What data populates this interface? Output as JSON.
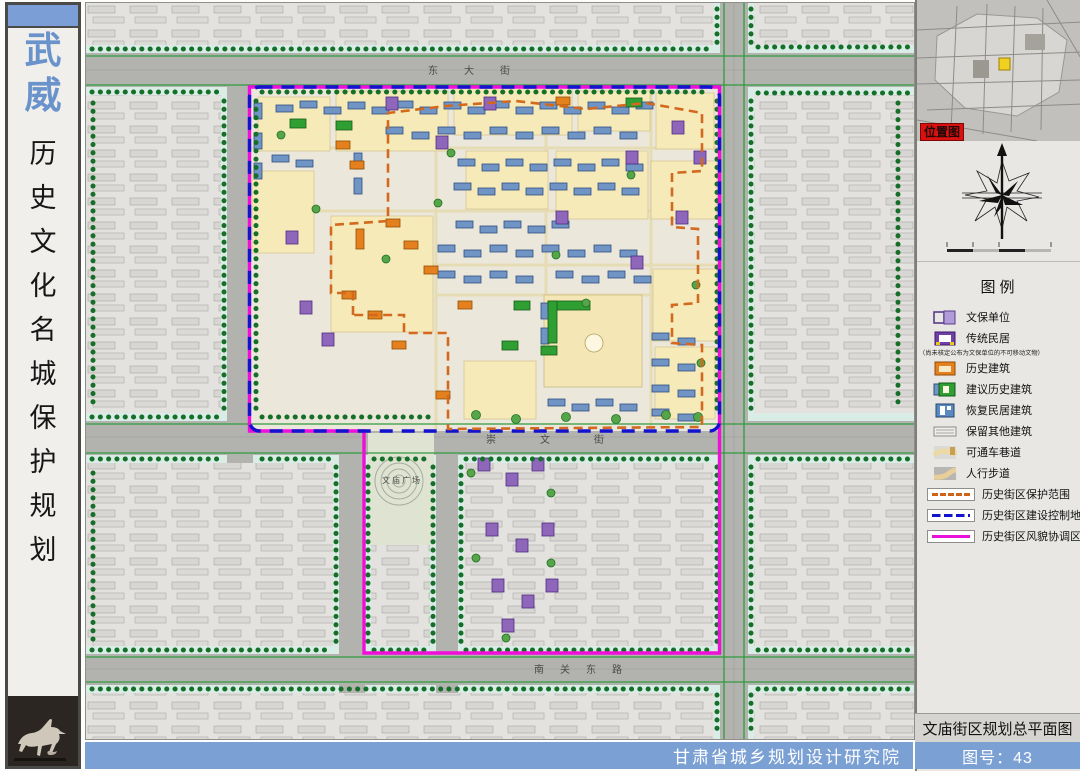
{
  "sidebar": {
    "city_chars": [
      "武",
      "威"
    ],
    "title_chars": [
      "历",
      "史",
      "文",
      "化",
      "名",
      "城",
      "保",
      "护",
      "规",
      "划"
    ],
    "logo": "flying-horse-bronze-statue"
  },
  "map": {
    "labels": {
      "top_street": "东大街",
      "middle_street": "崇文街",
      "bottom_street": "南关东路",
      "square": "文庙广场"
    },
    "boundary_colors": {
      "protection": "#cf6418",
      "construction_control": "#1414cc",
      "style_coordination": "#ea10da"
    }
  },
  "inset": {
    "label": "位置图"
  },
  "legend": {
    "title": "图例",
    "items": [
      {
        "label": "文保单位",
        "color": "#b09cd8"
      },
      {
        "label": "传统民居",
        "color": "#7040a8",
        "note": "（尚未核定公布为文保单位的不可移动文物）"
      },
      {
        "label": "历史建筑",
        "color": "#e4811e"
      },
      {
        "label": "建议历史建筑",
        "color": "#2f9e33"
      },
      {
        "label": "恢复民居建筑",
        "color": "#5c88c0"
      },
      {
        "label": "保留其他建筑",
        "color": "#e8e6e2"
      },
      {
        "label": "可通车巷道",
        "color": "#edd9a3"
      },
      {
        "label": "人行步道",
        "color": "#e8cf9a"
      }
    ],
    "lines": [
      {
        "label": "历史街区保护范围",
        "color": "#cf6418",
        "style": "dashed"
      },
      {
        "label": "历史街区建设控制地带",
        "color": "#1414cc",
        "style": "dash"
      },
      {
        "label": "历史街区风貌协调区",
        "color": "#ea10da",
        "style": "solid"
      }
    ]
  },
  "footer": {
    "institute": "甘肃省城乡规划设计研究院",
    "sheet_title": "文庙街区规划总平面图",
    "sheet_no": "图号：43"
  }
}
